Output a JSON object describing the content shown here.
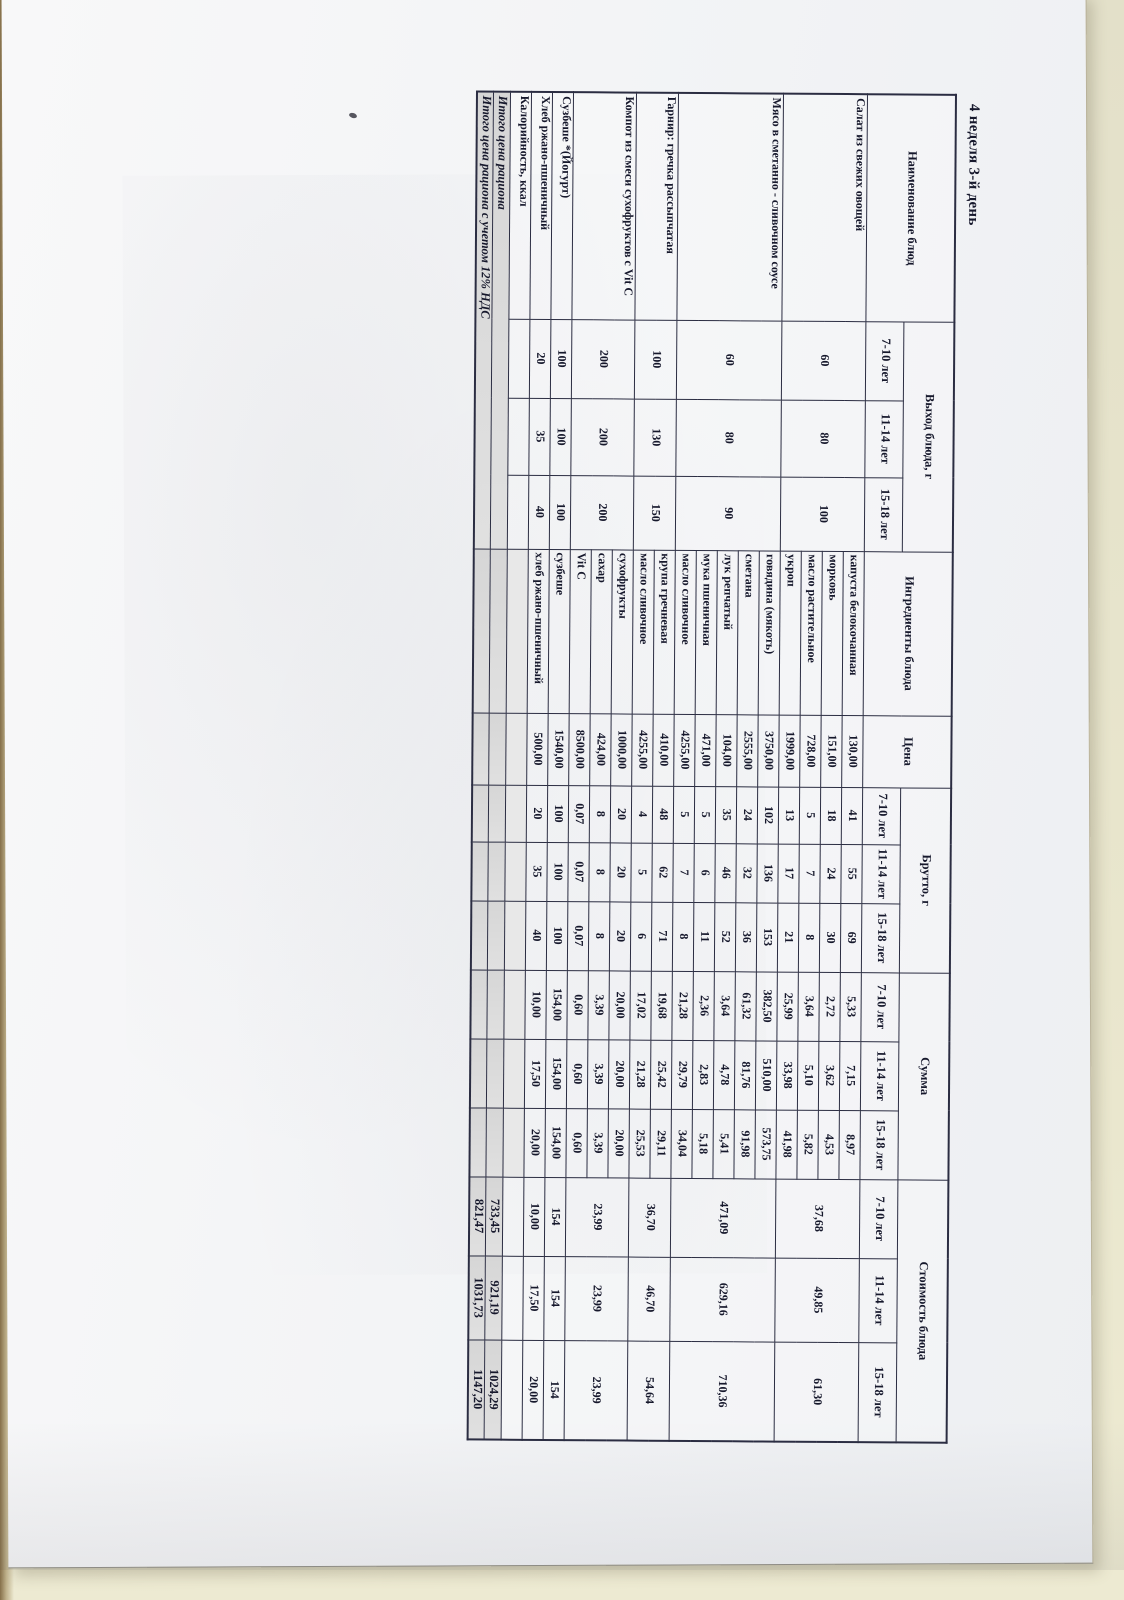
{
  "page_title": "4 неделя 3-й день",
  "colors": {
    "bg": "#e9e6cd",
    "paper": "#f5f5f7",
    "line": "#2b2d42",
    "ink": "#16182c"
  },
  "table": {
    "headers": {
      "name": "Наименование блюд",
      "yield": "Выход блюда, г",
      "ingredients": "Ингредиенты блюда",
      "price": "Цена",
      "gross": "Брутто, г",
      "sum": "Сумма",
      "cost": "Стоимость блюда",
      "ages": [
        "7-10 лет",
        "11-14 лет",
        "15-18 лет"
      ]
    },
    "dishes": [
      {
        "name": "Салат из свежих овощей",
        "yield": [
          "60",
          "80",
          "100"
        ],
        "cost": [
          "37,68",
          "49,85",
          "61,30"
        ],
        "ingredients": [
          {
            "name": "капуста белокочанная",
            "price": "130,00",
            "gross": [
              "41",
              "55",
              "69"
            ],
            "sum": [
              "5,33",
              "7,15",
              "8,97"
            ]
          },
          {
            "name": "морковь",
            "price": "151,00",
            "gross": [
              "18",
              "24",
              "30"
            ],
            "sum": [
              "2,72",
              "3,62",
              "4,53"
            ]
          },
          {
            "name": "масло растительное",
            "price": "728,00",
            "gross": [
              "5",
              "7",
              "8"
            ],
            "sum": [
              "3,64",
              "5,10",
              "5,82"
            ]
          },
          {
            "name": "укроп",
            "price": "1999,00",
            "gross": [
              "13",
              "17",
              "21"
            ],
            "sum": [
              "25,99",
              "33,98",
              "41,98"
            ]
          }
        ]
      },
      {
        "name": "Мясо в сметанно - сливочном соусе",
        "yield": [
          "60",
          "80",
          "90"
        ],
        "cost": [
          "471,09",
          "629,16",
          "710,36"
        ],
        "ingredients": [
          {
            "name": "говядина (мякоть)",
            "price": "3750,00",
            "gross": [
              "102",
              "136",
              "153"
            ],
            "sum": [
              "382,50",
              "510,00",
              "573,75"
            ]
          },
          {
            "name": "сметана",
            "price": "2555,00",
            "gross": [
              "24",
              "32",
              "36"
            ],
            "sum": [
              "61,32",
              "81,76",
              "91,98"
            ]
          },
          {
            "name": "лук репчатый",
            "price": "104,00",
            "gross": [
              "35",
              "46",
              "52"
            ],
            "sum": [
              "3,64",
              "4,78",
              "5,41"
            ]
          },
          {
            "name": "мука пшеничная",
            "price": "471,00",
            "gross": [
              "5",
              "6",
              "11"
            ],
            "sum": [
              "2,36",
              "2,83",
              "5,18"
            ]
          },
          {
            "name": "масло сливочное",
            "price": "4255,00",
            "gross": [
              "5",
              "7",
              "8"
            ],
            "sum": [
              "21,28",
              "29,79",
              "34,04"
            ]
          }
        ]
      },
      {
        "name": "Гарнир: гречка рассыпчатая",
        "yield": [
          "100",
          "130",
          "150"
        ],
        "cost": [
          "36,70",
          "46,70",
          "54,64"
        ],
        "ingredients": [
          {
            "name": "крупа гречневая",
            "price": "410,00",
            "gross": [
              "48",
              "62",
              "71"
            ],
            "sum": [
              "19,68",
              "25,42",
              "29,11"
            ]
          },
          {
            "name": "масло сливочное",
            "price": "4255,00",
            "gross": [
              "4",
              "5",
              "6"
            ],
            "sum": [
              "17,02",
              "21,28",
              "25,53"
            ]
          }
        ]
      },
      {
        "name": "Компот из смеси сухофруктов с Vit C",
        "yield": [
          "200",
          "200",
          "200"
        ],
        "cost": [
          "23,99",
          "23,99",
          "23,99"
        ],
        "ingredients": [
          {
            "name": "сухофрукты",
            "price": "1000,00",
            "gross": [
              "20",
              "20",
              "20"
            ],
            "sum": [
              "20,00",
              "20,00",
              "20,00"
            ]
          },
          {
            "name": "сахар",
            "price": "424,00",
            "gross": [
              "8",
              "8",
              "8"
            ],
            "sum": [
              "3,39",
              "3,39",
              "3,39"
            ]
          },
          {
            "name": "Vit C",
            "price": "8500,00",
            "gross": [
              "0,07",
              "0,07",
              "0,07"
            ],
            "sum": [
              "0,60",
              "0,60",
              "0,60"
            ]
          }
        ]
      },
      {
        "name": "Сузбеше *(Йогурт)",
        "yield": [
          "100",
          "100",
          "100"
        ],
        "cost": [
          "154",
          "154",
          "154"
        ],
        "ingredients": [
          {
            "name": "сузбеше",
            "price": "1540,00",
            "gross": [
              "100",
              "100",
              "100"
            ],
            "sum": [
              "154,00",
              "154,00",
              "154,00"
            ]
          }
        ]
      },
      {
        "name": "Хлеб ржано-пшеничный",
        "yield": [
          "20",
          "35",
          "40"
        ],
        "cost": [
          "10,00",
          "17,50",
          "20,00"
        ],
        "ingredients": [
          {
            "name": "хлеб ржано-пшеничный",
            "price": "500,00",
            "gross": [
              "20",
              "35",
              "40"
            ],
            "sum": [
              "10,00",
              "17,50",
              "20,00"
            ]
          }
        ]
      }
    ],
    "extra_rows": [
      {
        "name": "Калорийность, ккал",
        "values": [
          "",
          "",
          ""
        ]
      }
    ],
    "totals": [
      {
        "label": "Итого цена рациона",
        "values": [
          "733,45",
          "921,19",
          "1024,29"
        ]
      },
      {
        "label": "Итого цена рациона с учетом 12% НДС",
        "values": [
          "821,47",
          "1031,73",
          "1147,20"
        ]
      }
    ]
  }
}
